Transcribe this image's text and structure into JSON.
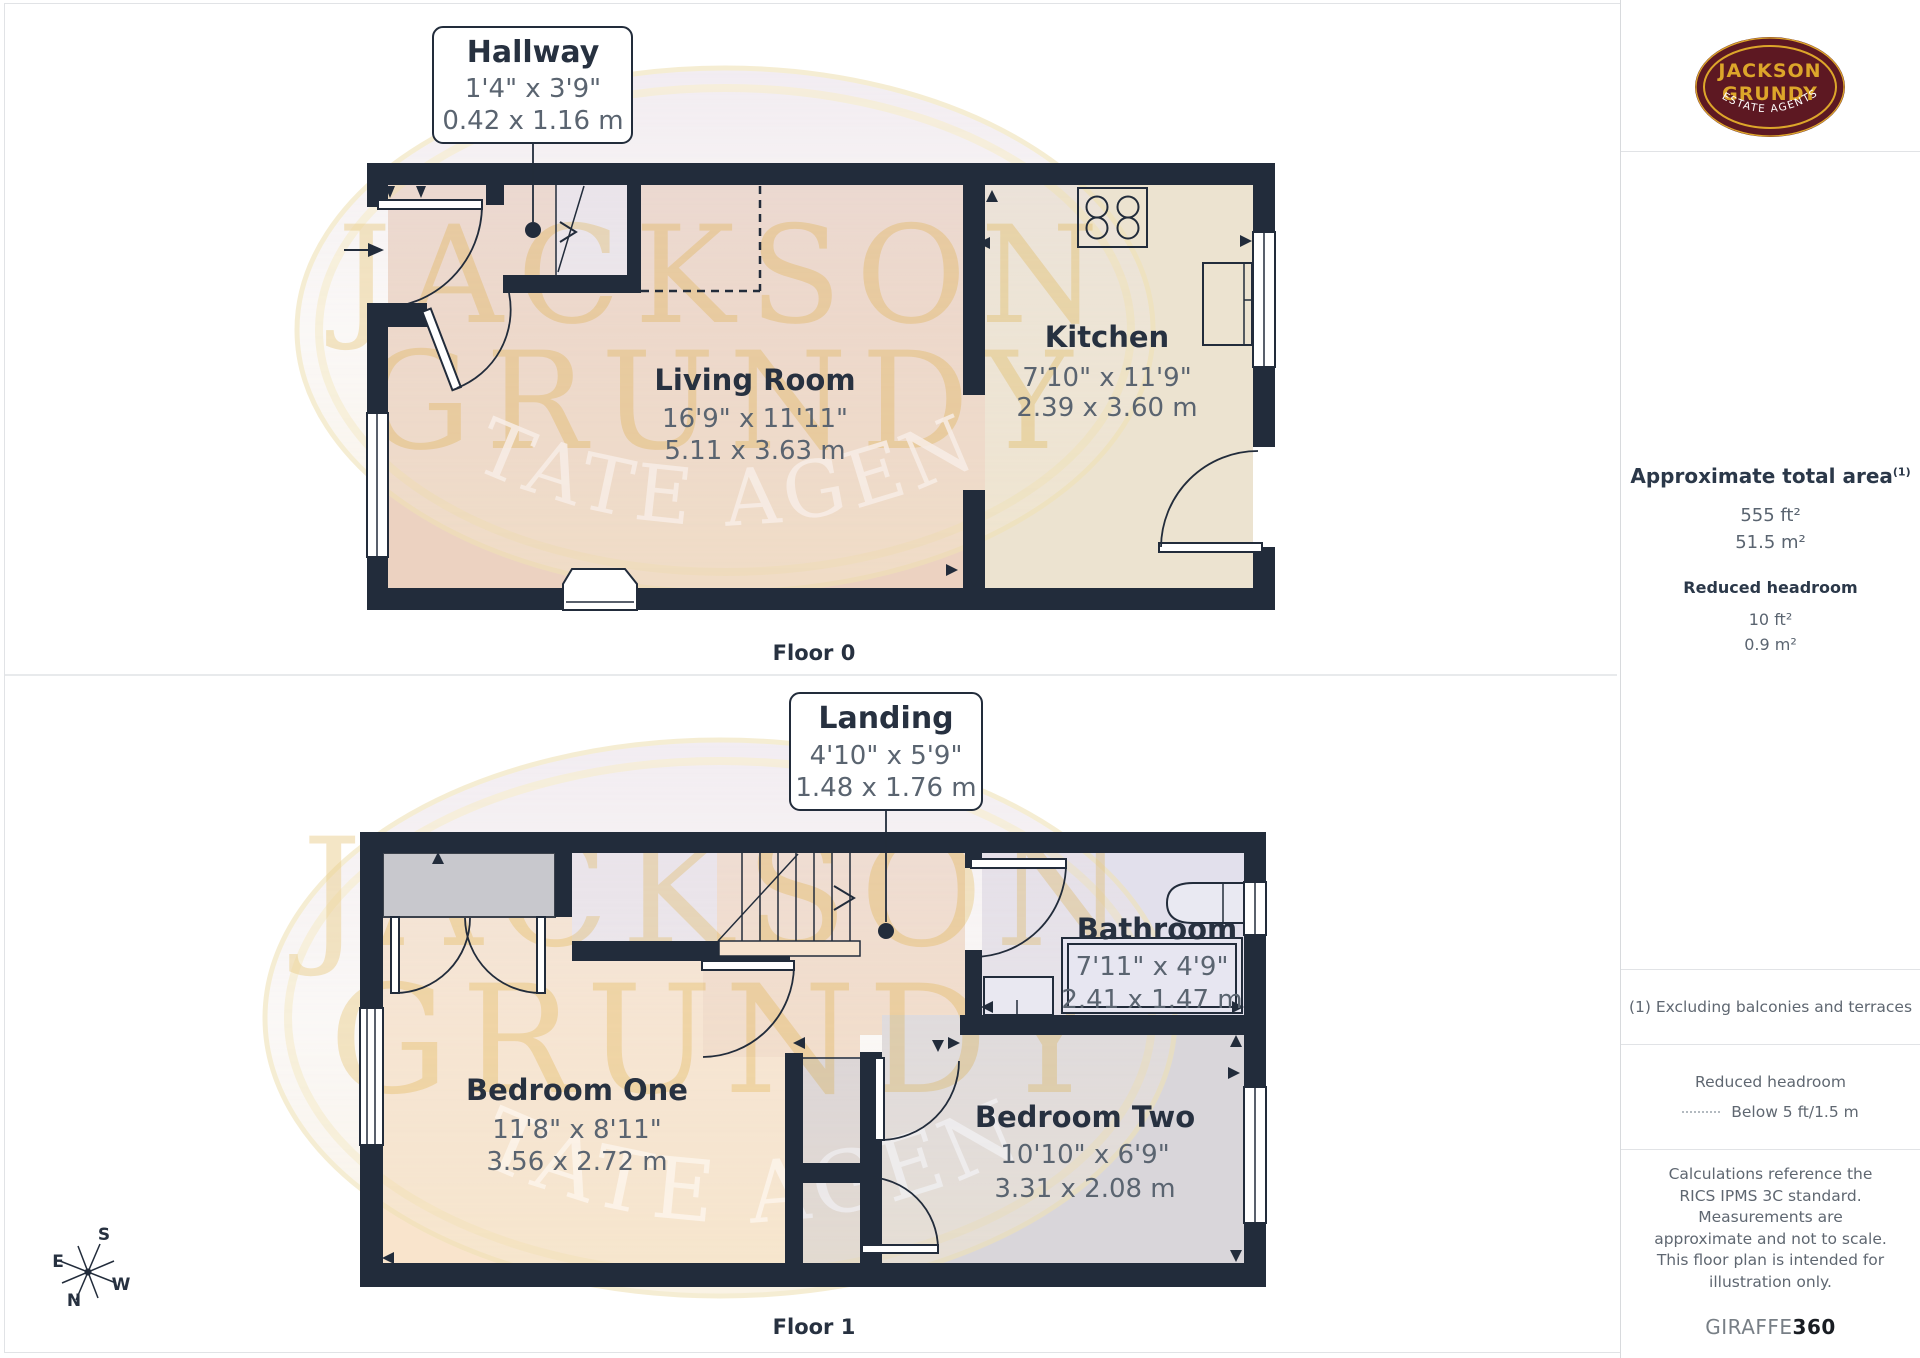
{
  "colors": {
    "wall": "#222c3b",
    "ink": "#273140",
    "gray": "#5a6470",
    "border": "#e1e3e6",
    "peach": "#ecd2c1",
    "peachlight": "#f9e4cc",
    "peachmid": "#f2d9c3",
    "cream": "#ece3d0",
    "lavender": "#eae6ef",
    "graywarm": "#d3ced3",
    "wardrobe": "#c8c8cd",
    "bath": "#e2e0ec",
    "bed2": "#d9d6da",
    "wmgold": "#dcae42",
    "wmring": "#f0e2b6",
    "wmpink": "#e9dfe8",
    "wmcream": "#f5e9cf",
    "maroon": "#5d1822",
    "gold": "#dda62a"
  },
  "brand": {
    "line1": "JACKSON",
    "line2": "GRUNDY",
    "tagline": "ESTATE AGENTS"
  },
  "watermark": {
    "line1": "JACKSON",
    "line2": "GRUNDY",
    "tagline": "ESTATE AGENTS"
  },
  "floor0": {
    "label": "Floor 0",
    "callout": {
      "title": "Hallway",
      "imperial": "1'4\" x 3'9\"",
      "metric": "0.42 x 1.16 m"
    },
    "living": {
      "name": "Living Room",
      "imperial": "16'9\" x 11'11\"",
      "metric": "5.11 x 3.63 m"
    },
    "kitchen": {
      "name": "Kitchen",
      "imperial": "7'10\" x 11'9\"",
      "metric": "2.39 x 3.60 m"
    }
  },
  "floor1": {
    "label": "Floor 1",
    "callout": {
      "title": "Landing",
      "imperial": "4'10\" x 5'9\"",
      "metric": "1.48 x 1.76 m"
    },
    "bedroom1": {
      "name": "Bedroom One",
      "imperial": "11'8\" x 8'11\"",
      "metric": "3.56 x 2.72 m"
    },
    "bedroom2": {
      "name": "Bedroom Two",
      "imperial": "10'10\" x 6'9\"",
      "metric": "3.31 x 2.08 m"
    },
    "bathroom": {
      "name": "Bathroom",
      "imperial": "7'11\" x 4'9\"",
      "metric": "2.41 x 1.47 m"
    }
  },
  "compass": {
    "n": "N",
    "e": "E",
    "s": "S",
    "w": "W"
  },
  "sidebar": {
    "total_area": {
      "heading": "Approximate total area",
      "footnote_ref": "(1)",
      "imperial": "555 ft²",
      "metric": "51.5 m²"
    },
    "reduced_headroom": {
      "heading": "Reduced headroom",
      "imperial": "10 ft²",
      "metric": "0.9 m²"
    },
    "footnote": "(1) Excluding balconies and terraces",
    "legend": {
      "heading": "Reduced headroom",
      "label": "Below 5 ft/1.5 m"
    },
    "disclaimer": "Calculations reference the RICS IPMS 3C standard. Measurements are approximate and not to scale. This floor plan is intended for illustration only.",
    "credit": {
      "brand": "GIRAFFE",
      "suffix": "360"
    }
  }
}
